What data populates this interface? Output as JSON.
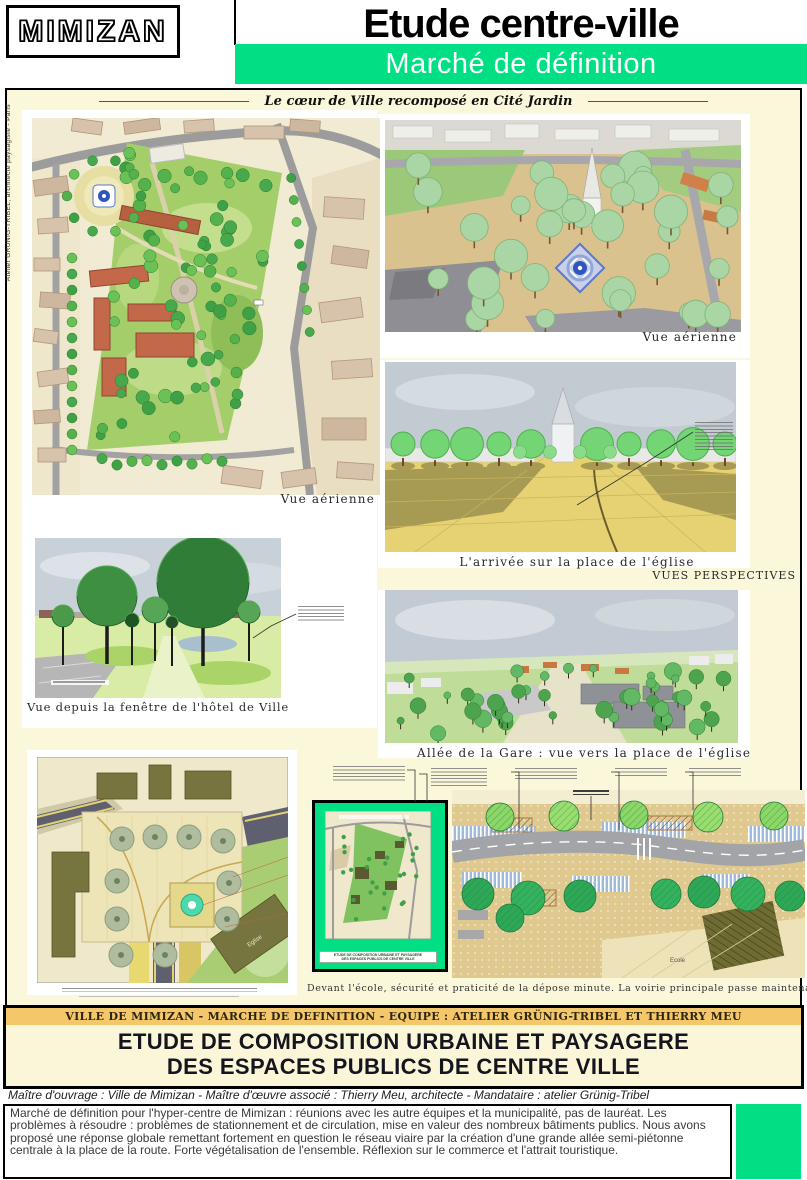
{
  "header": {
    "logo": "MIMIZAN",
    "title": "Etude centre-ville",
    "subtitle": "Marché de définition"
  },
  "poster": {
    "side_credit": "Atelier GRUNIG-TRIBEL, architecte paysagiste - Paris",
    "tagline": "Le cœur de Ville recomposé en Cité Jardin",
    "section_label": "VUES PERSPECTIVES",
    "captions": {
      "plan_aerial": "Vue aérienne",
      "aerial_right": "Vue aérienne",
      "arrival": "L'arrivée sur la place de l'église",
      "hotel_view": "Vue depuis la fenêtre de l'hôtel de Ville",
      "allee": "Allée de la Gare : vue vers la place de l'église",
      "school": "Devant l'école, sécurité et praticité de la dépose minute. La voirie principale passe maintenant plus loin."
    },
    "plan_labels": {
      "eglise": "Eglise",
      "ecole": "Ecole"
    },
    "inset_caption_line1": "ETUDE DE COMPOSITION URBAINE ET PAYSAGERE",
    "inset_caption_line2": "DES ESPACES PUBLICS DE CENTRE VILLE"
  },
  "footer": {
    "banner": "VILLE DE MIMIZAN  -  MARCHE DE DEFINITION  -  EQUIPE : ATELIER GRÜNIG-TRIBEL ET THIERRY MEU",
    "main_title_line1": "ETUDE DE COMPOSITION URBAINE ET PAYSAGERE",
    "main_title_line2": "DES ESPACES PUBLICS DE CENTRE VILLE",
    "credits": "Maître d'ouvrage : Ville de Mimizan  -  Maître d'œuvre associé : Thierry Meu, architecte  -   Mandataire : atelier Grünig-Tribel",
    "description": "Marché de définition pour l'hyper-centre de Mimizan : réunions avec les autre équipes et la municipalité, pas de lauréat. Les problèmes à résoudre : problèmes de stationnement et de circulation, mise en valeur des nombreux bâtiments publics. Nous avons proposé une réponse globale remettant fortement en question le réseau viaire par la création d'une grande allée semi-piétonne centrale à la place de la route. Forte végétalisation de l'ensemble. Réflexion sur le commerce et l'attrait touristique."
  },
  "colors": {
    "accent_green": "#00DF83",
    "banner_orange": "#F4C76B",
    "board_cream": "#FBF7DA"
  }
}
